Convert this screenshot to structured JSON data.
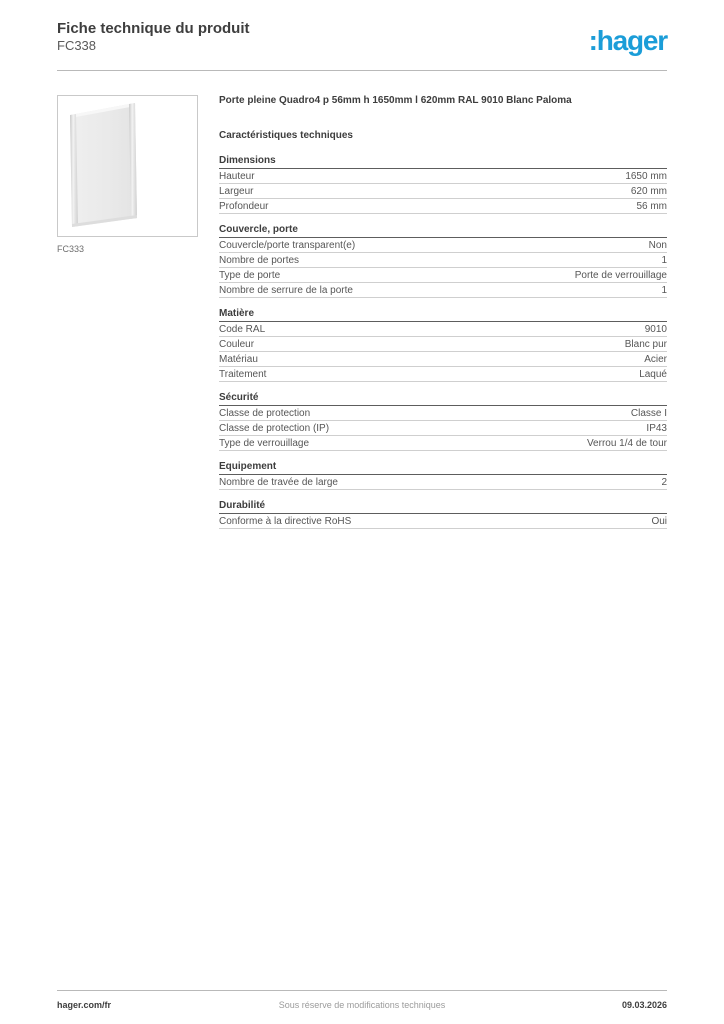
{
  "header": {
    "title": "Fiche technique du produit",
    "reference": "FC338",
    "logo_text": ":hager",
    "logo_color": "#1b9dd8"
  },
  "product": {
    "image_caption": "FC333",
    "image_alt": "door-panel-illustration",
    "title": "Porte pleine Quadro4 p 56mm h 1650mm l 620mm RAL 9010 Blanc Paloma",
    "characteristics_heading": "Caractéristiques techniques"
  },
  "sections": [
    {
      "title": "Dimensions",
      "rows": [
        {
          "label": "Hauteur",
          "value": "1650 mm"
        },
        {
          "label": "Largeur",
          "value": "620 mm"
        },
        {
          "label": "Profondeur",
          "value": "56 mm"
        }
      ]
    },
    {
      "title": "Couvercle, porte",
      "rows": [
        {
          "label": "Couvercle/porte transparent(e)",
          "value": "Non"
        },
        {
          "label": "Nombre de portes",
          "value": "1"
        },
        {
          "label": "Type de porte",
          "value": "Porte de verrouillage"
        },
        {
          "label": "Nombre de serrure de la porte",
          "value": "1"
        }
      ]
    },
    {
      "title": "Matière",
      "rows": [
        {
          "label": "Code RAL",
          "value": "9010"
        },
        {
          "label": "Couleur",
          "value": "Blanc pur"
        },
        {
          "label": "Matériau",
          "value": "Acier"
        },
        {
          "label": "Traitement",
          "value": "Laqué"
        }
      ]
    },
    {
      "title": "Sécurité",
      "rows": [
        {
          "label": "Classe de protection",
          "value": "Classe I"
        },
        {
          "label": "Classe de protection (IP)",
          "value": "IP43"
        },
        {
          "label": "Type de verrouillage",
          "value": "Verrou 1/4 de tour"
        }
      ]
    },
    {
      "title": "Equipement",
      "rows": [
        {
          "label": "Nombre de travée de large",
          "value": "2"
        }
      ]
    },
    {
      "title": "Durabilité",
      "rows": [
        {
          "label": "Conforme à la directive RoHS",
          "value": "Oui"
        }
      ]
    }
  ],
  "footer": {
    "left": "hager.com/fr",
    "center": "Sous réserve de modifications techniques",
    "right": "09.03.2026"
  }
}
